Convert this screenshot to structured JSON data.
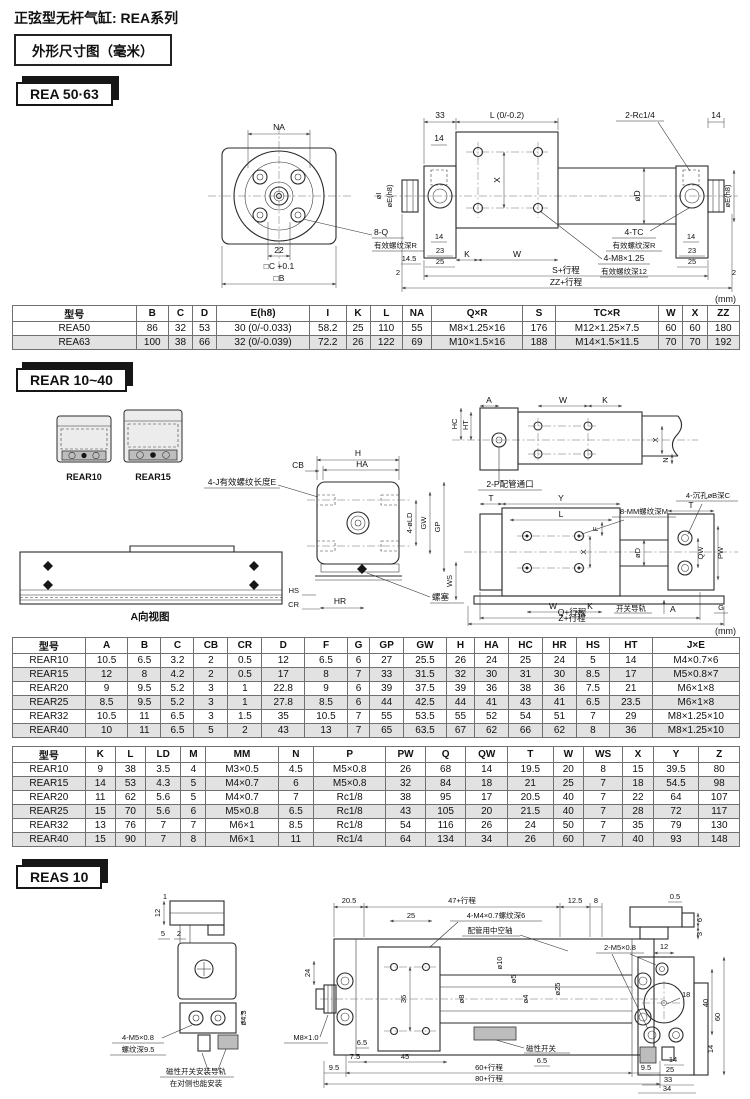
{
  "page": {
    "title": "正弦型无杆气缸: REA系列",
    "subtitle": "外形尺寸图（毫米）",
    "unit": "(mm)"
  },
  "rea": {
    "tag": "REA 50·63",
    "front": {
      "na": "NA",
      "span22": "22",
      "c": "□C +0.1",
      "b": "□B",
      "q": "8-Q",
      "q_note": "有效螺纹深R",
      "oi": "øI",
      "oe": "øE(h8)"
    },
    "side": {
      "d33": "33",
      "l": "L (0/-0.2)",
      "rc": "2-Rc1/4",
      "d14": "14",
      "x": "X",
      "od": "øD",
      "oe": "øE(h8)",
      "tc": "4-TC",
      "tc_note": "有效螺纹深R",
      "m8": "4-M8×1.25",
      "m8_note": "有效螺纹深12",
      "d23": "23",
      "d25": "25",
      "d145": "14.5",
      "d2": "2",
      "k": "K",
      "w": "W",
      "s": "S+行程",
      "zz": "ZZ+行程"
    },
    "table": {
      "headers": [
        "型号",
        "B",
        "C",
        "D",
        "E(h8)",
        "I",
        "K",
        "L",
        "NA",
        "Q×R",
        "S",
        "TC×R",
        "W",
        "X",
        "ZZ"
      ],
      "rows": [
        [
          "REA50",
          "86",
          "32",
          "53",
          "30 (0/-0.033)",
          "58.2",
          "25",
          "110",
          "55",
          "M8×1.25×16",
          "176",
          "M12×1.25×7.5",
          "60",
          "60",
          "180"
        ],
        [
          "REA63",
          "100",
          "38",
          "66",
          "32 (0/-0.039)",
          "72.2",
          "26",
          "122",
          "69",
          "M10×1.5×16",
          "188",
          "M14×1.5×11.5",
          "70",
          "70",
          "192"
        ]
      ]
    }
  },
  "rear": {
    "tag": "REAR 10~40",
    "products": [
      "REAR10",
      "REAR15"
    ],
    "mid": {
      "cb": "CB",
      "h": "H",
      "ha": "HA",
      "j": "4-J有效螺纹长度E",
      "ld": "4-øLD",
      "gw": "GW",
      "gp": "GP",
      "hs": "HS",
      "cr": "CR",
      "hr": "HR",
      "plug": "螺塞",
      "ws": "WS"
    },
    "top_right": {
      "a": "A",
      "w": "W",
      "k": "K",
      "hc": "HC",
      "ht": "HT",
      "x": "X",
      "n": "N",
      "port": "2-P配管通口"
    },
    "bottom_right": {
      "t": "T",
      "y": "Y",
      "l": "L",
      "mm": "8-MM螺纹深M",
      "sink": "4-沉孔øB深C",
      "f": "F",
      "od": "øD",
      "x": "X",
      "qw": "QW",
      "pw": "PW",
      "w": "W",
      "k": "K",
      "rail": "开关导轨",
      "a": "A",
      "g": "G",
      "q": "Q+行程",
      "z": "Z+行程"
    },
    "a_view": {
      "label": "A向视图"
    },
    "table1": {
      "headers": [
        "型号",
        "A",
        "B",
        "C",
        "CB",
        "CR",
        "D",
        "F",
        "G",
        "GP",
        "GW",
        "H",
        "HA",
        "HC",
        "HR",
        "HS",
        "HT",
        "J×E"
      ],
      "rows": [
        [
          "REAR10",
          "10.5",
          "6.5",
          "3.2",
          "2",
          "0.5",
          "12",
          "6.5",
          "6",
          "27",
          "25.5",
          "26",
          "24",
          "25",
          "24",
          "5",
          "14",
          "M4×0.7×6"
        ],
        [
          "REAR15",
          "12",
          "8",
          "4.2",
          "2",
          "0.5",
          "17",
          "8",
          "7",
          "33",
          "31.5",
          "32",
          "30",
          "31",
          "30",
          "8.5",
          "17",
          "M5×0.8×7"
        ],
        [
          "REAR20",
          "9",
          "9.5",
          "5.2",
          "3",
          "1",
          "22.8",
          "9",
          "6",
          "39",
          "37.5",
          "39",
          "36",
          "38",
          "36",
          "7.5",
          "21",
          "M6×1×8"
        ],
        [
          "REAR25",
          "8.5",
          "9.5",
          "5.2",
          "3",
          "1",
          "27.8",
          "8.5",
          "6",
          "44",
          "42.5",
          "44",
          "41",
          "43",
          "41",
          "6.5",
          "23.5",
          "M6×1×8"
        ],
        [
          "REAR32",
          "10.5",
          "11",
          "6.5",
          "3",
          "1.5",
          "35",
          "10.5",
          "7",
          "55",
          "53.5",
          "55",
          "52",
          "54",
          "51",
          "7",
          "29",
          "M8×1.25×10"
        ],
        [
          "REAR40",
          "10",
          "11",
          "6.5",
          "5",
          "2",
          "43",
          "13",
          "7",
          "65",
          "63.5",
          "67",
          "62",
          "66",
          "62",
          "8",
          "36",
          "M8×1.25×10"
        ]
      ]
    },
    "table2": {
      "headers": [
        "型号",
        "K",
        "L",
        "LD",
        "M",
        "MM",
        "N",
        "P",
        "PW",
        "Q",
        "QW",
        "T",
        "W",
        "WS",
        "X",
        "Y",
        "Z"
      ],
      "rows": [
        [
          "REAR10",
          "9",
          "38",
          "3.5",
          "4",
          "M3×0.5",
          "4.5",
          "M5×0.8",
          "26",
          "68",
          "14",
          "19.5",
          "20",
          "8",
          "15",
          "39.5",
          "80"
        ],
        [
          "REAR15",
          "14",
          "53",
          "4.3",
          "5",
          "M4×0.7",
          "6",
          "M5×0.8",
          "32",
          "84",
          "18",
          "21",
          "25",
          "7",
          "18",
          "54.5",
          "98"
        ],
        [
          "REAR20",
          "11",
          "62",
          "5.6",
          "5",
          "M4×0.7",
          "7",
          "Rc1/8",
          "38",
          "95",
          "17",
          "20.5",
          "40",
          "7",
          "22",
          "64",
          "107"
        ],
        [
          "REAR25",
          "15",
          "70",
          "5.6",
          "6",
          "M5×0.8",
          "6.5",
          "Rc1/8",
          "43",
          "105",
          "20",
          "21.5",
          "40",
          "7",
          "28",
          "72",
          "117"
        ],
        [
          "REAR32",
          "13",
          "76",
          "7",
          "7",
          "M6×1",
          "8.5",
          "Rc1/8",
          "54",
          "116",
          "26",
          "24",
          "50",
          "7",
          "35",
          "79",
          "130"
        ],
        [
          "REAR40",
          "15",
          "90",
          "7",
          "8",
          "M6×1",
          "11",
          "Rc1/4",
          "64",
          "134",
          "34",
          "26",
          "60",
          "7",
          "40",
          "93",
          "148"
        ]
      ]
    }
  },
  "reas": {
    "tag": "REAS 10",
    "left": {
      "d1": "1",
      "d12": "12",
      "d5": "5",
      "d2": "2",
      "o43": "ø4.3",
      "m5": "4-M5×0.8",
      "m5_note": "螺纹深9.5",
      "note1": "磁性开关安装导轨",
      "note2": "在对侧也能安装"
    },
    "mid": {
      "d205": "20.5",
      "d47": "47+行程",
      "d125": "12.5",
      "d8": "8",
      "d25": "25",
      "m4": "4-M4×0.7螺纹深6",
      "hollow": "配管用中空轴",
      "o10": "ø10",
      "o5": "ø5",
      "o8": "ø8",
      "o4": "ø4",
      "o25": "ø25",
      "d36": "36",
      "d24": "24",
      "m8": "M8×1.0",
      "d65a": "6.5",
      "d75": "7.5",
      "d45": "45",
      "sw": "磁性开关",
      "d65b": "6.5",
      "d60": "60+行程",
      "d80": "80+行程",
      "d95": "9.5"
    },
    "right": {
      "d05": "0.5",
      "d6": "6",
      "d3": "3",
      "m5": "2-M5×0.8",
      "d12": "12",
      "d18": "18",
      "d40": "40",
      "d60": "60",
      "d14": "14",
      "d25": "25",
      "d33": "33",
      "d34": "34"
    }
  }
}
